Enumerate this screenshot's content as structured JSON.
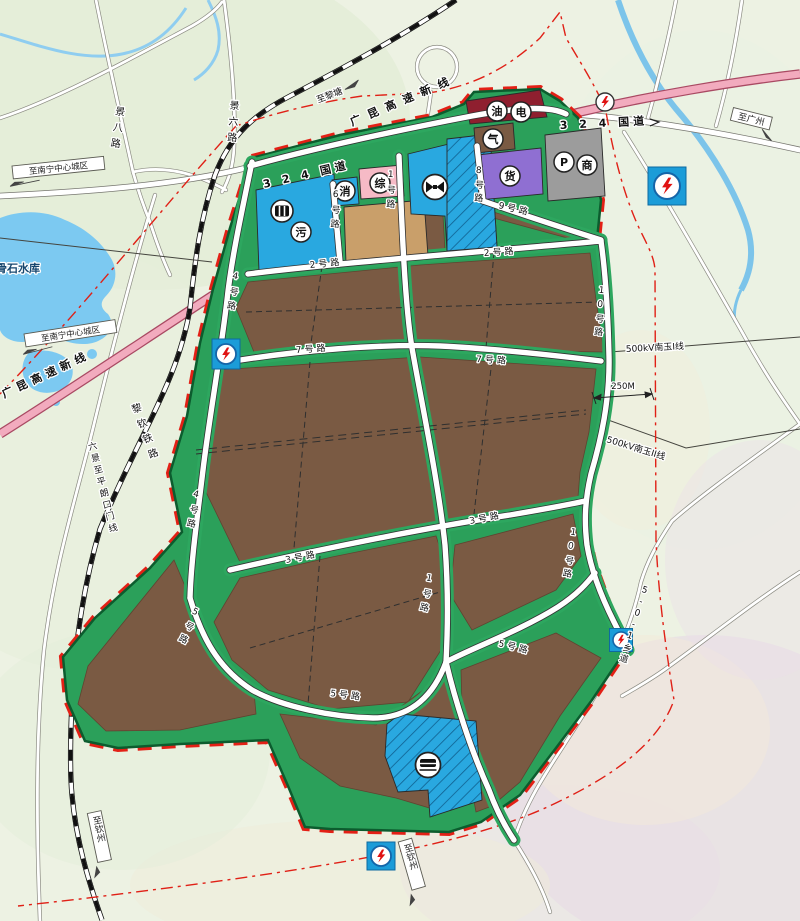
{
  "labels": {
    "national_road": "3 2 4 国道",
    "expressway": "广昆高速新线",
    "railway": "黎钦铁路",
    "to_litang": "至黎塘",
    "to_guangzhou": "至广州",
    "to_qinzhou": "至钦州",
    "to_nanning": "至南宁中心城区",
    "reservoir": "骨石水库",
    "jing6": "景六路",
    "jing8": "景八路",
    "liujing_pinglang": "六景至平朗口门线",
    "township_501": "5-0-1乡道",
    "kv_line1": "500kV南玉I线",
    "kv_line2": "500kV南玉II线",
    "dim_250m": "250M",
    "road1": "1号路",
    "road2": "2号路",
    "road3": "3号路",
    "road4": "4号路",
    "road5": "5号路",
    "road6": "6号路",
    "road7": "7号路",
    "road8": "8号路",
    "road9": "9号路",
    "road10": "10号路"
  },
  "icons": {
    "oil": "油",
    "electric": "电",
    "gas": "气",
    "freight": "货",
    "parking": "P",
    "commerce": "商",
    "fire": "消",
    "comprehensive": "综",
    "sewage": "污"
  },
  "colors": {
    "park_green": "#2ba05a",
    "parcel_brown": "#7a5a43",
    "water_blue": "#7cc9f1",
    "facility_blue": "#29a8e0",
    "expressway_pink": "#f2abbe",
    "boundary_red": "#e02016",
    "purple_parcel": "#8f6fd2",
    "gray_parcel": "#9c9c9c",
    "pink_parcel": "#f6bac6",
    "tan_parcel": "#c99f6a",
    "dark_red_parcel": "#8f1f2f"
  }
}
